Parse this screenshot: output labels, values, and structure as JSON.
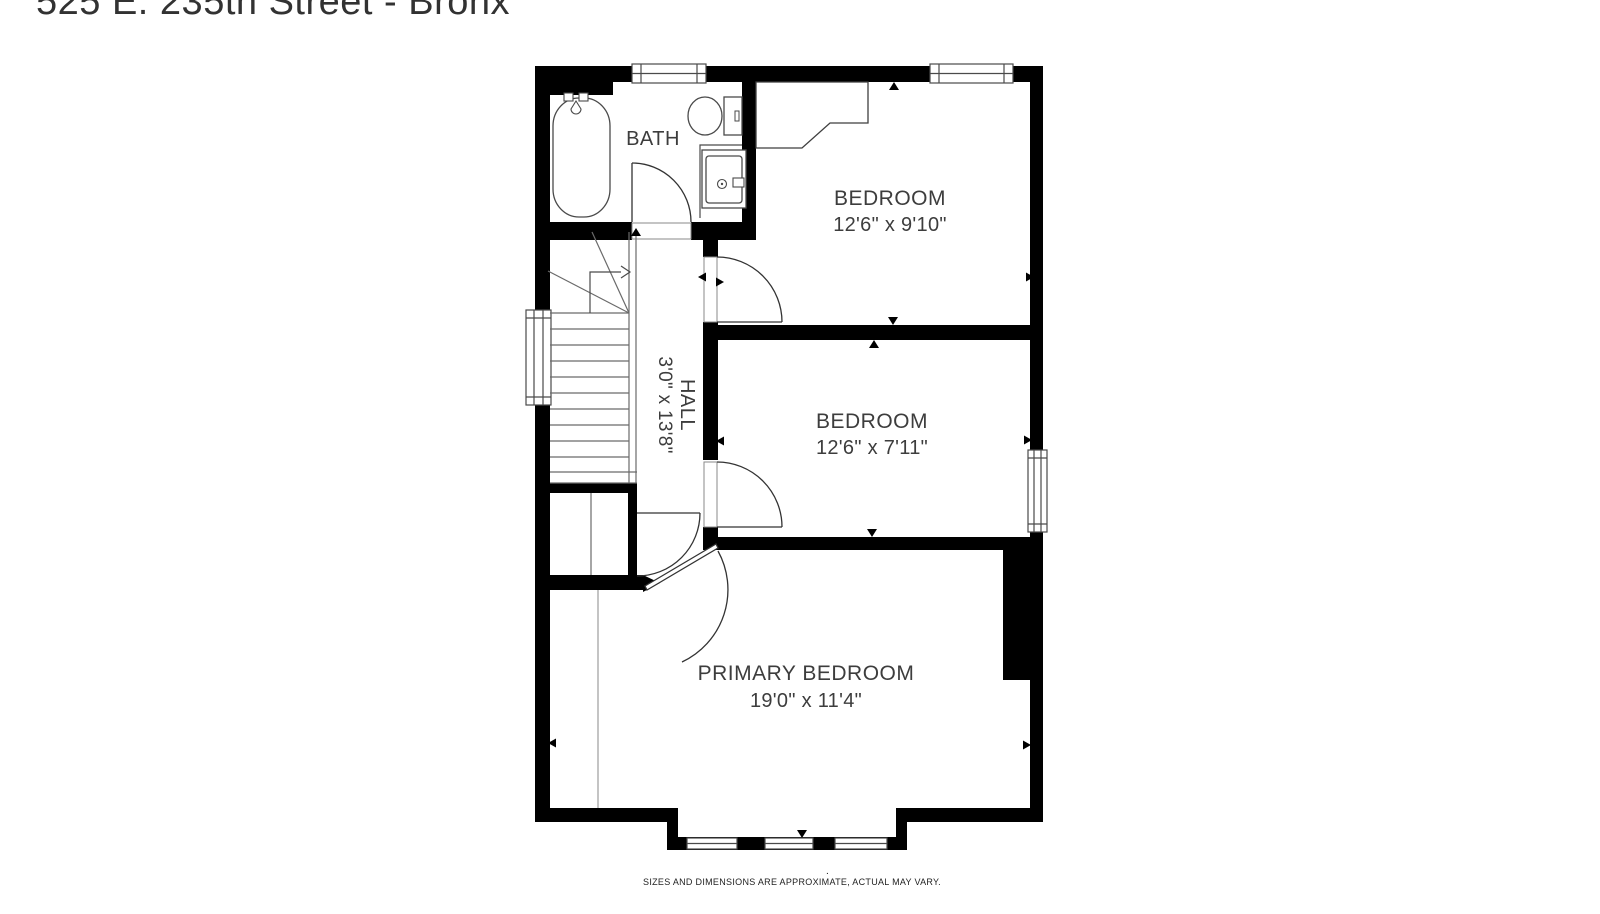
{
  "title": "525 E. 235th Street - Bronx",
  "rooms": {
    "bath": {
      "label": "BATH"
    },
    "bedroom1": {
      "label": "BEDROOM",
      "dims": "12'6\" x 9'10\""
    },
    "bedroom2": {
      "label": "BEDROOM",
      "dims": "12'6\" x 7'11\""
    },
    "hall": {
      "label": "HALL",
      "dims": "3'0\" x 13'8\""
    },
    "primary": {
      "label": "PRIMARY BEDROOM",
      "dims": "19'0\" x 11'4\""
    }
  },
  "disclaimer": "SIZES AND DIMENSIONS ARE APPROXIMATE, ACTUAL MAY VARY.",
  "stray_mark": ".",
  "colors": {
    "wall": "#000000",
    "fixture_line": "#4a4a4a",
    "stair_line": "#6a6a6a",
    "text": "#3d3d3d",
    "background": "#ffffff"
  }
}
